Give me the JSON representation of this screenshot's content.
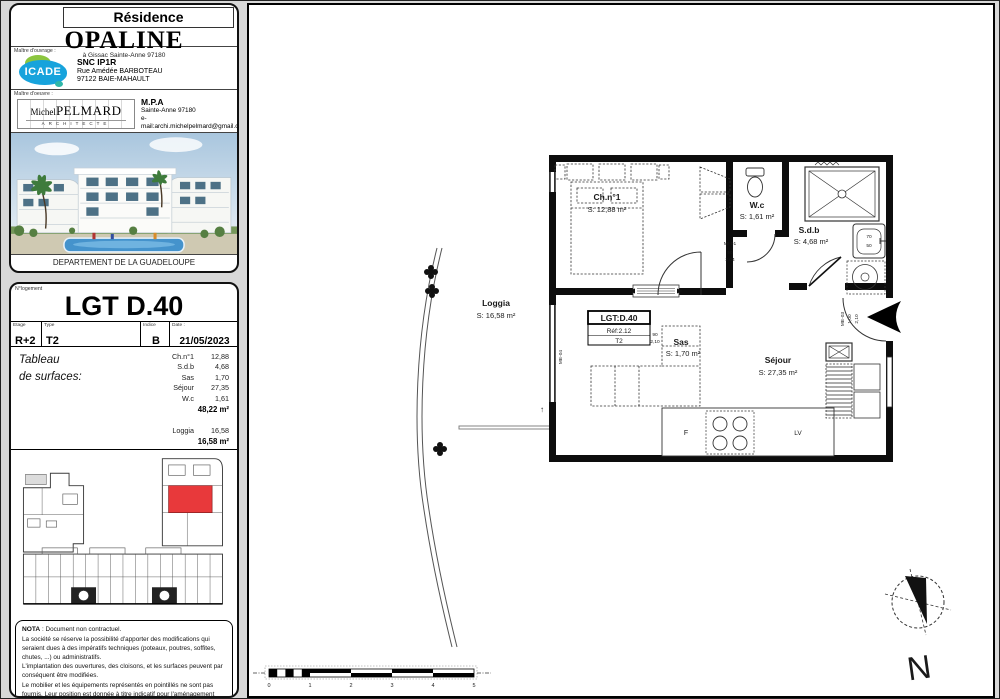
{
  "header": {
    "residence_label": "Résidence",
    "residence_name": "OPALINE",
    "residence_address": "à Gissac Sainte-Anne 97180",
    "owner": {
      "section_label": "Maître d'ouvrage :",
      "logo_text": "ICADE",
      "name": "SNC IP1R",
      "address1": "Rue Amédée BARBOTEAU",
      "address2": "97122 BAIE-MAHAULT"
    },
    "architect": {
      "section_label": "Maître d'oeuvre :",
      "logo_first": "Michel",
      "logo_last": "PELMARD",
      "logo_sub": "ARCHITECTE",
      "name": "M.P.A",
      "address1": "Sainte-Anne 97180",
      "email": "e-mail:archi.michelpelmard@gmail.com"
    },
    "region_caption": "DEPARTEMENT DE LA GUADELOUPE"
  },
  "unit_block": {
    "lot_label": "N°logement",
    "lot_title": "LGT D.40",
    "fields": [
      {
        "label": "Etage",
        "value": "R+2"
      },
      {
        "label": "Type",
        "value": "T2"
      },
      {
        "label": "Indice",
        "value": "B"
      },
      {
        "label": "Date :",
        "value": "21/05/2023"
      }
    ],
    "surfaces": {
      "title1": "Tableau",
      "title2": "de surfaces:",
      "rows": [
        {
          "name": "Ch.n°1",
          "value": "12,88"
        },
        {
          "name": "S.d.b",
          "value": "4,68"
        },
        {
          "name": "Sas",
          "value": "1,70"
        },
        {
          "name": "Séjour",
          "value": "27,35"
        },
        {
          "name": "W.c",
          "value": "1,61"
        }
      ],
      "total": "48,22 m²",
      "loggia": {
        "name": "Loggia",
        "value": "16,58"
      },
      "loggia_total": "16,58 m²"
    }
  },
  "nota": {
    "title": "NOTA",
    "intro": " : Document non contractuel.",
    "p1": "La société se réserve la possibilité d'apporter des modifications qui seraient dues à des impératifs techniques (poteaux, poutres, soffites, chutes, ...) ou administratifs.",
    "p2": "L'implantation des ouvertures, des cloisons, et les surfaces peuvent par conséquent être modifiées.",
    "p3": "Le mobilier et les équipements représentés en pointillés ne sont pas fournis. Leur position est donnée à titre indicatif pour l'aménagement futur. Seuls le lavabo, la douche et les WC sont fournis, tel que décrit dans la Notice Descriptive Sommaire."
  },
  "plan": {
    "rooms": {
      "ch1": {
        "name": "Ch.n°1",
        "area": "S: 12,88 m²"
      },
      "wc": {
        "name": "W.c",
        "area": "S: 1,61 m²"
      },
      "sdb": {
        "name": "S.d.b",
        "area": "S: 4,68 m²"
      },
      "sas": {
        "name": "Sas",
        "area": "S: 1,70 m²"
      },
      "sejour": {
        "name": "Séjour",
        "area": "S: 27,35 m²"
      },
      "loggia": {
        "name": "Loggia",
        "area": "S: 16,58 m²"
      }
    },
    "tag": {
      "line1": "LGT:D.40",
      "line2": "Réf:2.12",
      "line3": "T2"
    },
    "kitchen": {
      "fridge": "F",
      "dishwasher": "LV"
    },
    "labels": {
      "door_mi01": "MI-01",
      "door_mi01_dim1": "90",
      "door_mi01_dim2": "2,04",
      "door_sas_dim1": "90",
      "door_sas_dim2": "2,10",
      "door_me03": "ME-03",
      "door_me03_dim1": "1,00",
      "door_me03_dim2": "2,10",
      "window_me04": "ME-04",
      "basin_w": "70",
      "basin_d": "50",
      "level_arrow": "↑"
    },
    "compass_label": "N",
    "scale_ticks": [
      "0",
      "1",
      "2",
      "3",
      "4",
      "5"
    ]
  },
  "colors": {
    "accent_red": "#e8393b",
    "icade_blue": "#17a3dc",
    "icade_green": "#8bc53f"
  }
}
